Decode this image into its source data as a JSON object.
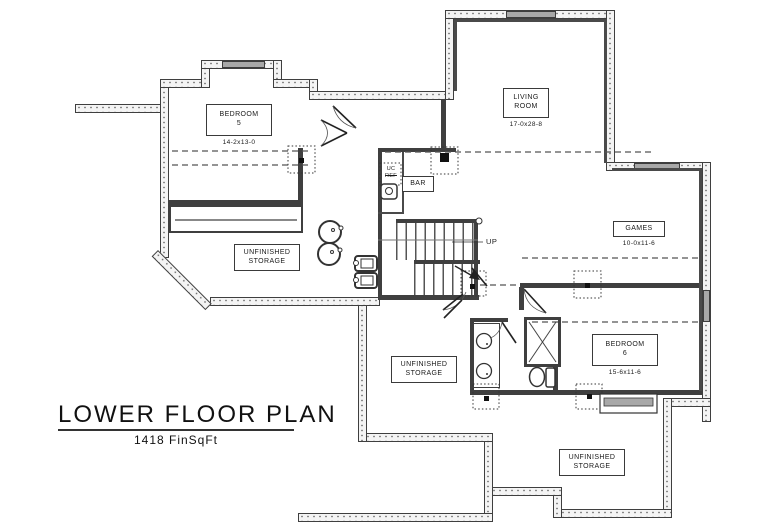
{
  "title": {
    "main": "LOWER FLOOR PLAN",
    "area": "1418 FinSqFt"
  },
  "rooms": {
    "bedroom5": {
      "label": "BEDROOM\n5",
      "dims": "14-2x13-0"
    },
    "living_room": {
      "label": "LIVING\nROOM",
      "dims": "17-0x28-8"
    },
    "games": {
      "label": "GAMES",
      "dims": "10-0x11-6"
    },
    "bedroom6": {
      "label": "BEDROOM\n6",
      "dims": "15-6x11-6"
    },
    "storage_upper": {
      "label": "UNFINISHED\nSTORAGE"
    },
    "storage_middle": {
      "label": "UNFINISHED\nSTORAGE"
    },
    "storage_lower": {
      "label": "UNFINISHED\nSTORAGE"
    },
    "bar": {
      "label": "BAR"
    }
  },
  "annotations": {
    "up": "UP",
    "uc": "UC",
    "ref": "REF"
  },
  "colors": {
    "wall_dark": "#3f3f3f",
    "stipple_fill": "#f4f4f4",
    "window_gray": "#a8a8a8",
    "paper": "#ffffff"
  }
}
